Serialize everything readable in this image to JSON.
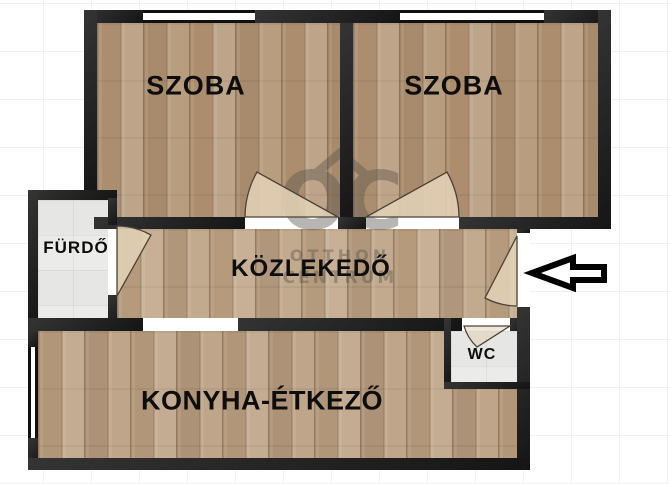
{
  "floorplan": {
    "labels": {
      "room1": "SZOBA",
      "room2": "SZOBA",
      "bathroom": "FÜRDŐ",
      "hallway": "KÖZLEKEDŐ",
      "wc": "WC",
      "kitchen_dining": "KONYHA-ÉTKEZŐ"
    },
    "watermark": {
      "logo": "OC",
      "line1": "OTTHON",
      "line2": "CENTRUM"
    },
    "entrance": {
      "symbol": "left-arrow"
    },
    "colors": {
      "wall": "#1d1d1d",
      "room_floor": "#b59878",
      "hall_floor": "#bfa588",
      "kitchen_floor": "#bca184",
      "tile_floor": "#ebebe9",
      "door_fan": "#e3d2b6",
      "arrow_fill": "#ffffff",
      "arrow_outline": "#000000"
    }
  }
}
